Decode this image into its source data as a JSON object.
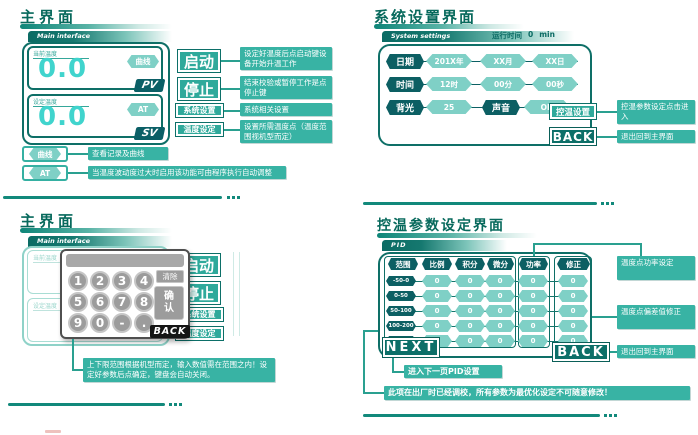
{
  "colors": {
    "accent_dark": "#0b6b64",
    "accent": "#2fa99b",
    "annotation_bg": "#38b3a4",
    "accent_light": "#7fd0c6",
    "display_cyan": "#40d4cd",
    "badge_dark": "#0b5f66",
    "keypad_gray": "#9c9c9c",
    "back_black": "#151515"
  },
  "top_left": {
    "title": "主界面",
    "tag": "Main interface",
    "display": {
      "pv_label": "当前温度",
      "pv_value": "0.0",
      "pv_badge": "PV",
      "curve_button": "曲线",
      "sv_label": "设定温度",
      "sv_value": "0.0",
      "sv_badge": "SV",
      "at_button": "AT"
    },
    "buttons": {
      "start": "启动",
      "stop": "停止",
      "system": "系统设置",
      "temp_set": "温度设定"
    },
    "legend": {
      "curve": "曲线",
      "at": "AT"
    },
    "annotations": {
      "start": "设定好温度后点启动键设备开始升温工作",
      "stop": "结束校验或暂停工作是点停止键",
      "system": "系统相关设置",
      "temp_set": "设置所需温度点（温度范围视机型而定）",
      "curve": "查看记录及曲线",
      "at": "当温度波动度过大时启用该功能可由程序执行自动调整"
    }
  },
  "top_right": {
    "title": "系统设置界面",
    "tag": "System settings",
    "runtime": {
      "label": "运行时间",
      "value": "0",
      "unit": "min"
    },
    "rows": [
      {
        "label": "日期",
        "values": [
          "201X年",
          "XX月",
          "XX日"
        ]
      },
      {
        "label": "时间",
        "values": [
          "12时",
          "00分",
          "00秒"
        ]
      }
    ],
    "backlight": {
      "label": "背光",
      "value": "25"
    },
    "sound": {
      "label": "声音",
      "value": "ON"
    },
    "buttons": {
      "temp_ctrl": "控温设置",
      "back": "BACK"
    },
    "annotations": {
      "temp_ctrl": "控温参数设定点击进入",
      "back": "退出回到主界面"
    }
  },
  "bottom_left": {
    "title": "主界面",
    "tag": "Main interface",
    "display": {
      "pv_label": "当前温度",
      "sv_label": "设定温度"
    },
    "buttons": {
      "start": "启动",
      "stop": "停止",
      "system": "系统设置",
      "temp_set": "温度设定"
    },
    "keypad": {
      "digits": [
        "1",
        "2",
        "3",
        "4",
        "5",
        "6",
        "7",
        "8",
        "9",
        "0",
        "-",
        "."
      ],
      "clear": "清除",
      "confirm": "确认",
      "back": "BACK"
    },
    "annotation": "上下限范围根据机型而定，输入数值需在范围之内！设定好参数后点确定，键盘会自动关闭。"
  },
  "bottom_right": {
    "title": "控温参数设定界面",
    "tag": "PID",
    "columns": [
      "范围",
      "比例",
      "积分",
      "微分",
      "功率",
      "修正"
    ],
    "rows": [
      {
        "range": "-50-0",
        "values": [
          "0",
          "0",
          "0",
          "0",
          "0"
        ]
      },
      {
        "range": "0-50",
        "values": [
          "0",
          "0",
          "0",
          "0",
          "0"
        ]
      },
      {
        "range": "50-100",
        "values": [
          "0",
          "0",
          "0",
          "0",
          "0"
        ]
      },
      {
        "range": "100-200",
        "values": [
          "0",
          "0",
          "0",
          "0",
          "0"
        ]
      },
      {
        "range": "200-300",
        "values": [
          "0",
          "0",
          "0",
          "0",
          "0"
        ]
      }
    ],
    "buttons": {
      "next": "NEXT",
      "back": "BACK"
    },
    "annotations": {
      "power": "温度点功率设定",
      "correction": "温度点偏差值修正",
      "back": "退出回到主界面",
      "next": "进入下一页PID设置",
      "note": "此项在出厂时已经调校，所有参数为最优化设定不可随意修改！"
    }
  }
}
